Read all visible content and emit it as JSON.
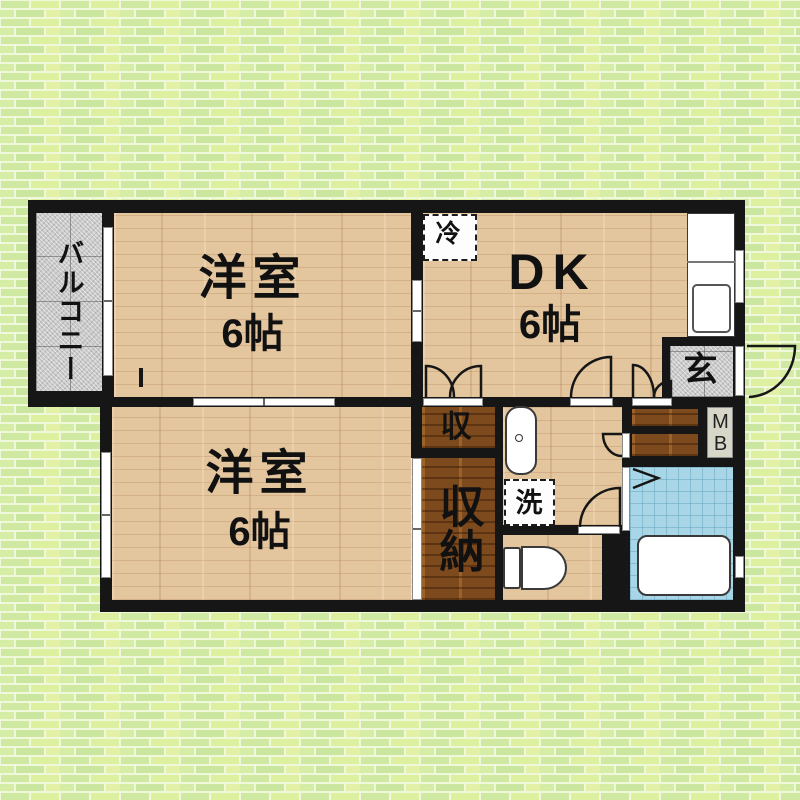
{
  "rooms": {
    "balcony": {
      "name": "バルコニー"
    },
    "bedroom_top": {
      "name": "洋室",
      "size": "6帖"
    },
    "bedroom_bottom": {
      "name": "洋室",
      "size": "6帖"
    },
    "dining_kitchen": {
      "name": "DK",
      "size": "6帖"
    },
    "entrance": {
      "name": "玄"
    },
    "storage_upper": {
      "name": "収"
    },
    "closet": {
      "name": "収納"
    }
  },
  "fixtures": {
    "refrigerator": {
      "label": "冷"
    },
    "washing_machine": {
      "label": "洗"
    },
    "meter_box": {
      "label": "MB"
    }
  },
  "colors": {
    "background_brick": "#d7edaa",
    "brick_mortar": "#f0f8dc",
    "wall": "#161616",
    "light_wood_floor": "#e4c69e",
    "dark_wood_storage": "#7c4a1d",
    "gray_tile": "#c9c9c9",
    "blue_tile": "#a9d6e6",
    "fixture_white": "#ffffff",
    "text": "#111111"
  }
}
